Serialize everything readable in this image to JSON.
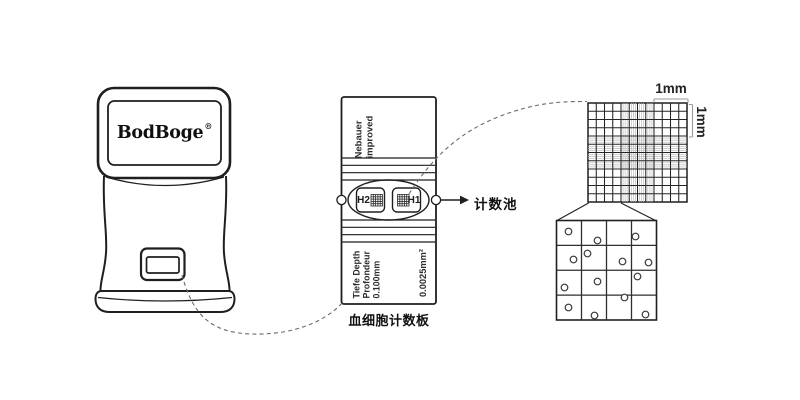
{
  "colors": {
    "ink": "#1f1f1f",
    "fine": "#b9b9b9",
    "bracket": "#9a9a9a",
    "dash": "#6a6a6a",
    "text": "#222222"
  },
  "device": {
    "brand": "BodBoge",
    "reg_mark": "®"
  },
  "slide": {
    "chamber_type_line1": "Nebauer",
    "chamber_type_line2": "improved",
    "well_left": "H2",
    "well_right": "H1",
    "pointer_label": "计数池",
    "depth_line1": "Tiefe Depth",
    "depth_line2": "Profondeur",
    "depth_line3": "0.100mm",
    "area_label": "0.0025mm²",
    "caption": "血细胞计数板"
  },
  "magnified_grid": {
    "width_label": "1mm",
    "height_label": "1mm",
    "spec": {
      "cells": 12,
      "fine_from": 4,
      "fine_to": 8,
      "fine_per_cell": 4
    }
  },
  "cell_view": {
    "cells": 4,
    "circles": [
      [
        12,
        11
      ],
      [
        41,
        20
      ],
      [
        79,
        16
      ],
      [
        17,
        39
      ],
      [
        31,
        33
      ],
      [
        66,
        41
      ],
      [
        92,
        42
      ],
      [
        81,
        56
      ],
      [
        41,
        61
      ],
      [
        8,
        67
      ],
      [
        68,
        77
      ],
      [
        12,
        87
      ],
      [
        38,
        95
      ],
      [
        89,
        94
      ]
    ]
  }
}
